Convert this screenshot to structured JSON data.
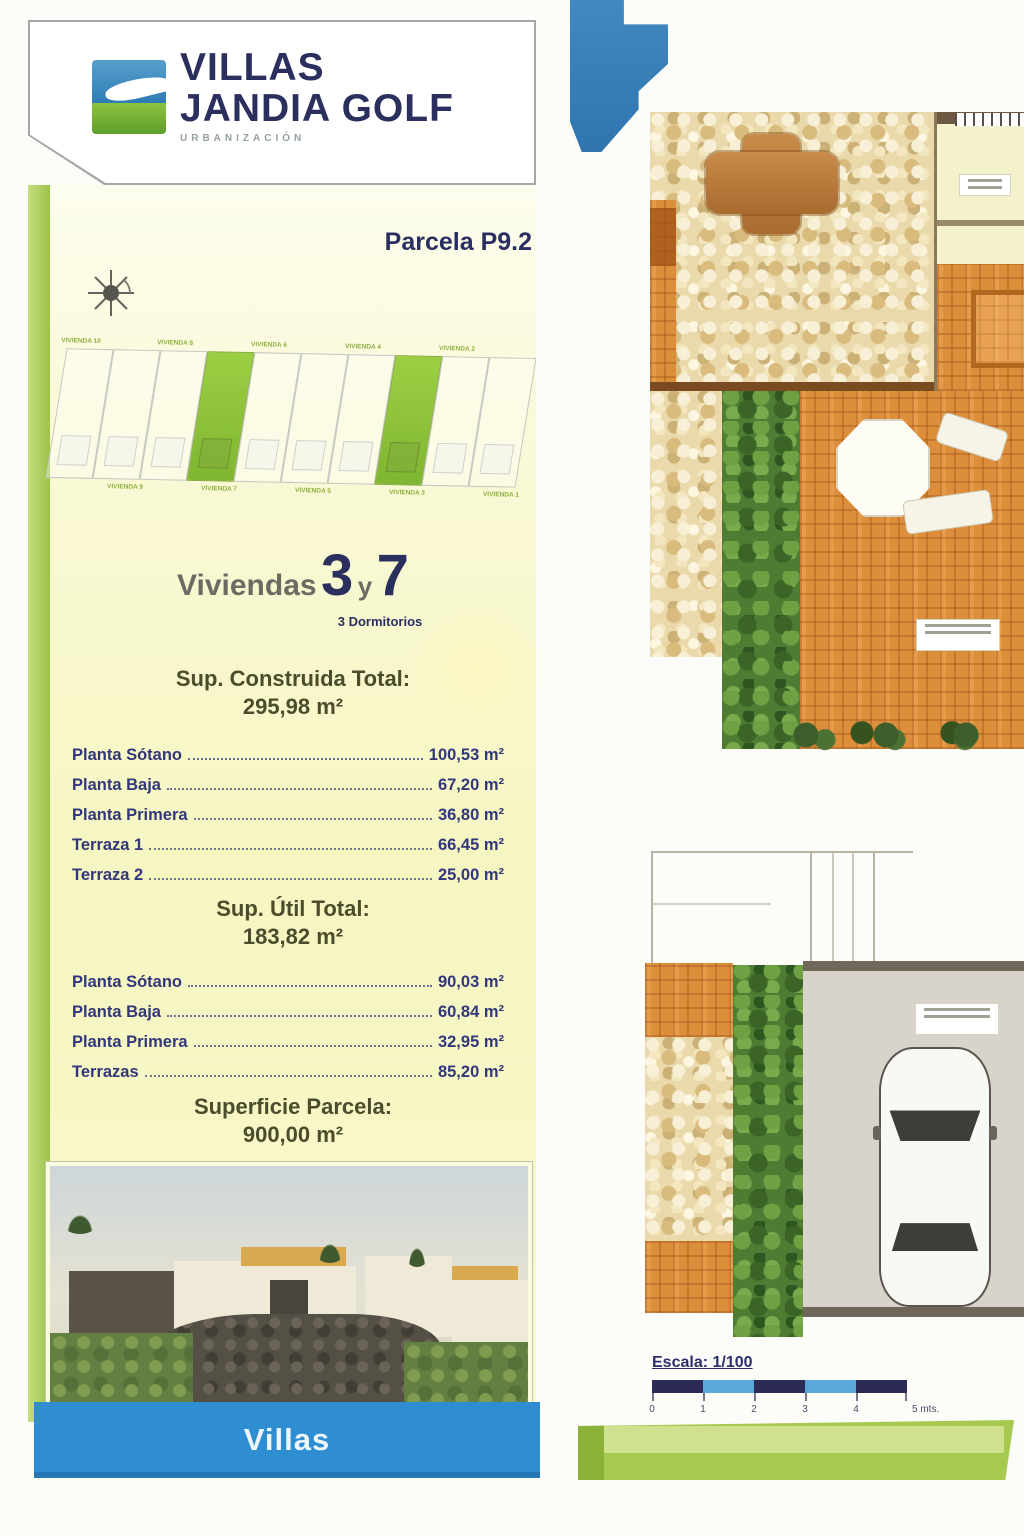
{
  "brand": {
    "line1": "VILLAS",
    "line2": "JANDIA GOLF",
    "subtitle": "URBANIZACIÓN"
  },
  "parcel": {
    "label": "Parcela P9.2"
  },
  "site_plan": {
    "plots": [
      {
        "label": "VIVIENDA 10",
        "label_position": "top",
        "highlighted": false
      },
      {
        "label": "VIVIENDA 9",
        "label_position": "bottom",
        "highlighted": false
      },
      {
        "label": "VIVIENDA 8",
        "label_position": "top",
        "highlighted": false
      },
      {
        "label": "VIVIENDA 7",
        "label_position": "bottom",
        "highlighted": true
      },
      {
        "label": "VIVIENDA 6",
        "label_position": "top",
        "highlighted": false
      },
      {
        "label": "VIVIENDA 5",
        "label_position": "bottom",
        "highlighted": false
      },
      {
        "label": "VIVIENDA 4",
        "label_position": "top",
        "highlighted": false
      },
      {
        "label": "VIVIENDA 3",
        "label_position": "bottom",
        "highlighted": true
      },
      {
        "label": "VIVIENDA 2",
        "label_position": "top",
        "highlighted": false
      },
      {
        "label": "VIVIENDA 1",
        "label_position": "bottom",
        "highlighted": false
      }
    ]
  },
  "unit": {
    "prefix": "Viviendas",
    "num1": "3",
    "conjunction": "y",
    "num2": "7",
    "bedrooms": "3 Dormitorios"
  },
  "built": {
    "title": "Sup. Construida Total:",
    "total": "295,98 m²",
    "rows": [
      {
        "label": "Planta Sótano",
        "value": "100,53 m²"
      },
      {
        "label": "Planta Baja",
        "value": "67,20 m²"
      },
      {
        "label": "Planta Primera",
        "value": "36,80 m²"
      },
      {
        "label": "Terraza 1",
        "value": "66,45 m²"
      },
      {
        "label": "Terraza 2",
        "value": "25,00 m²"
      }
    ]
  },
  "useful": {
    "title": "Sup. Útil Total:",
    "total": "183,82 m²",
    "rows": [
      {
        "label": "Planta Sótano",
        "value": "90,03 m²"
      },
      {
        "label": "Planta Baja",
        "value": "60,84 m²"
      },
      {
        "label": "Planta Primera",
        "value": "32,95 m²"
      },
      {
        "label": "Terrazas",
        "value": "85,20 m²"
      }
    ]
  },
  "parcel_area": {
    "title": "Superficie Parcela:",
    "value": "900,00 m²"
  },
  "footer": {
    "label": "Villas"
  },
  "scale": {
    "label": "Escala: 1/100",
    "ticks": [
      "0",
      "1",
      "2",
      "3",
      "4",
      "5 mts."
    ]
  },
  "colors": {
    "accent_green": "#8fc63f",
    "brand_navy": "#2a2f5e",
    "footer_blue": "#2f8dd1",
    "panel_yellow": "#f6f6c2"
  }
}
